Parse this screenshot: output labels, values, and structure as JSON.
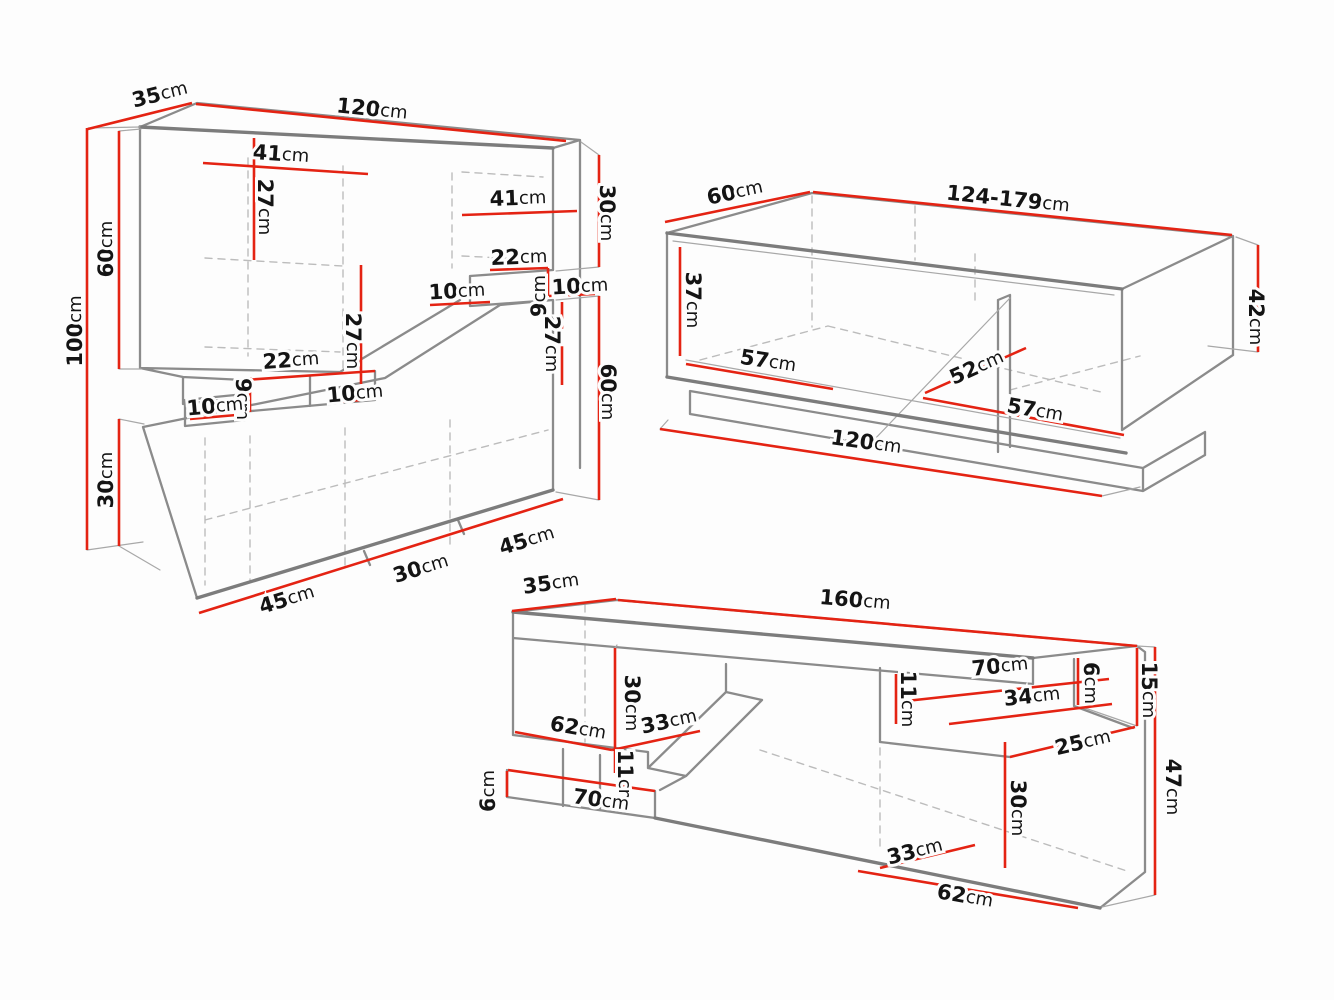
{
  "colors": {
    "background": "#fdfdfd",
    "outline": "#8b8b8b",
    "hidden_edges": "#bcbcbc",
    "dimension_red": "#e42313",
    "label_text": "#141414"
  },
  "drawings": {
    "wall_unit": {
      "labels": {
        "depth35": {
          "v": "35",
          "u": "cm"
        },
        "width120": {
          "v": "120",
          "u": "cm"
        },
        "shelf41a": {
          "v": "41",
          "u": "cm"
        },
        "h27a": {
          "v": "27",
          "u": "cm"
        },
        "shelf41b": {
          "v": "41",
          "u": "cm"
        },
        "right30": {
          "v": "30",
          "u": "cm"
        },
        "shelf22a": {
          "v": "22",
          "u": "cm"
        },
        "gap9r": {
          "v": "9",
          "u": "cm"
        },
        "gap10a": {
          "v": "10",
          "u": "cm"
        },
        "gap10b": {
          "v": "10",
          "u": "cm"
        },
        "right60": {
          "v": "60",
          "u": "cm"
        },
        "h27b": {
          "v": "27",
          "u": "cm"
        },
        "h27c": {
          "v": "27",
          "u": "cm"
        },
        "shelf22b": {
          "v": "22",
          "u": "cm"
        },
        "gap9l": {
          "v": "9",
          "u": "cm"
        },
        "gap10c": {
          "v": "10",
          "u": "cm"
        },
        "gap10d": {
          "v": "10",
          "u": "cm"
        },
        "total100": {
          "v": "100",
          "u": "cm"
        },
        "left60": {
          "v": "60",
          "u": "cm"
        },
        "left30": {
          "v": "30",
          "u": "cm"
        },
        "bottom45a": {
          "v": "45",
          "u": "cm"
        },
        "bottom30": {
          "v": "30",
          "u": "cm"
        },
        "bottom45b": {
          "v": "45",
          "u": "cm"
        }
      }
    },
    "coffee_table": {
      "labels": {
        "depth60": {
          "v": "60",
          "u": "cm"
        },
        "width124": {
          "v": "124-179",
          "u": "cm"
        },
        "h37": {
          "v": "37",
          "u": "cm"
        },
        "floor57a": {
          "v": "57",
          "u": "cm"
        },
        "floor52": {
          "v": "52",
          "u": "cm"
        },
        "floor57b": {
          "v": "57",
          "u": "cm"
        },
        "height42": {
          "v": "42",
          "u": "cm"
        },
        "width120": {
          "v": "120",
          "u": "cm"
        }
      }
    },
    "tv_stand": {
      "labels": {
        "depth35": {
          "v": "35",
          "u": "cm"
        },
        "width160": {
          "v": "160",
          "u": "cm"
        },
        "h30left": {
          "v": "30",
          "u": "cm"
        },
        "shelf62": {
          "v": "62",
          "u": "cm"
        },
        "shelf33": {
          "v": "33",
          "u": "cm"
        },
        "h11left": {
          "v": "11",
          "u": "cm"
        },
        "h6left": {
          "v": "6",
          "u": "cm"
        },
        "shelf70bottom": {
          "v": "70",
          "u": "cm"
        },
        "shelf70top": {
          "v": "70",
          "u": "cm"
        },
        "shelf34": {
          "v": "34",
          "u": "cm"
        },
        "h11mid": {
          "v": "11",
          "u": "cm"
        },
        "h6right": {
          "v": "6",
          "u": "cm"
        },
        "h15": {
          "v": "15",
          "u": "cm"
        },
        "shelf25": {
          "v": "25",
          "u": "cm"
        },
        "height47": {
          "v": "47",
          "u": "cm"
        },
        "h30right": {
          "v": "30",
          "u": "cm"
        },
        "floor33": {
          "v": "33",
          "u": "cm"
        },
        "floor62": {
          "v": "62",
          "u": "cm"
        }
      }
    }
  }
}
